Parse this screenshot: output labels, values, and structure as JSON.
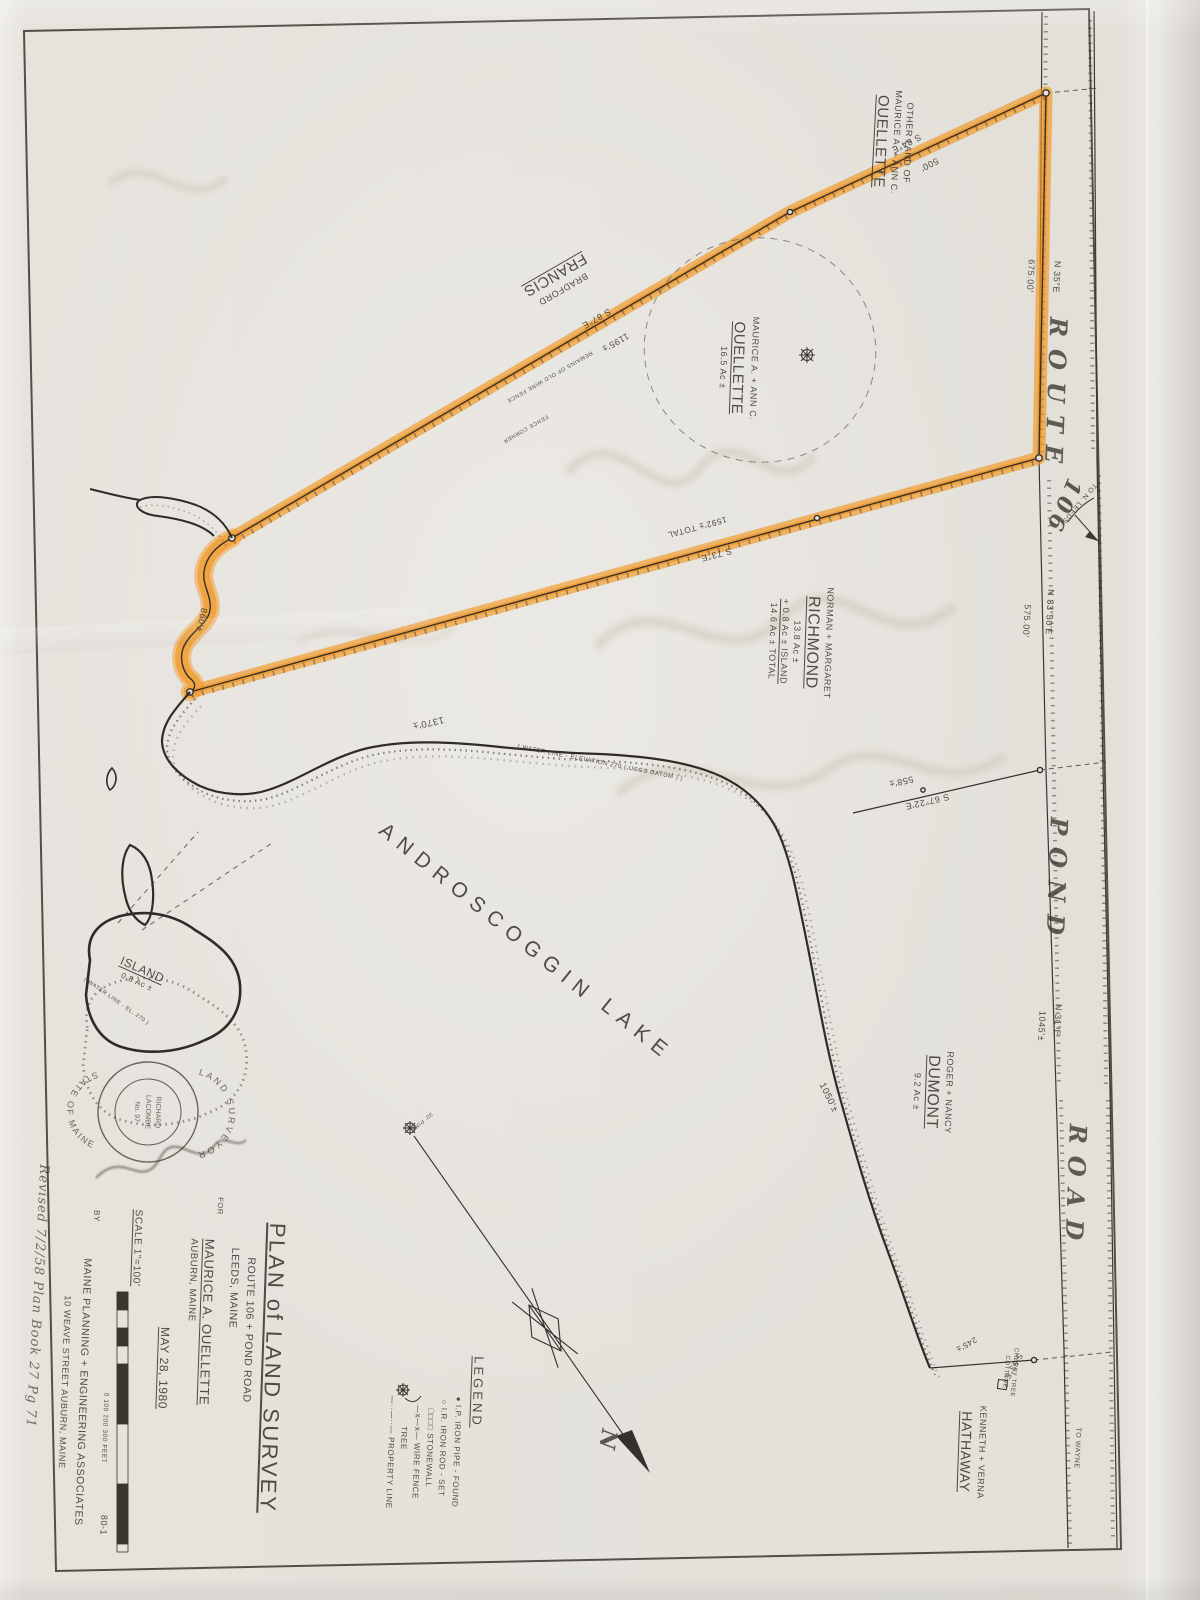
{
  "document": {
    "kind": "scanned land survey plan",
    "sheet_number": "80-1"
  },
  "colors": {
    "highlighter_orange": "#f29318",
    "ink": "#3a352f",
    "paper": "#e3e0da"
  },
  "stamp": {
    "ring_top": "LAND SURVEYOR",
    "ring_bottom": "STATE OF MAINE",
    "line1": "RICHARD",
    "line2": "LACOMBE",
    "line3": "No. 97"
  },
  "labels": [
    {
      "name": "owner-other-land-ouellette",
      "x": 892,
      "y": 142,
      "rot": 93,
      "size": 9,
      "lines": [
        {
          "t": "OTHER LAND OF"
        },
        {
          "t": "MAURICE A. + ANN C."
        },
        {
          "t": "OUELLETTE",
          "u": true,
          "s": 15
        }
      ]
    },
    {
      "name": "owner-francis",
      "x": 558,
      "y": 280,
      "rot": 150,
      "size": 9,
      "lines": [
        {
          "t": "BRADFORD"
        },
        {
          "t": "FRANCIS",
          "u": true,
          "s": 15
        }
      ]
    },
    {
      "name": "owner-ouellette-parcel",
      "x": 738,
      "y": 368,
      "rot": 92,
      "size": 9,
      "lines": [
        {
          "t": "MAURICE A. + ANN C."
        },
        {
          "t": "OUELLETTE",
          "u": true,
          "s": 15
        },
        {
          "t": "16.5 Ac ±"
        }
      ]
    },
    {
      "name": "owner-richmond",
      "x": 800,
      "y": 642,
      "rot": 92,
      "size": 9,
      "lines": [
        {
          "t": "NORMAN + MARGARET"
        },
        {
          "t": "RICHMOND",
          "u": true,
          "s": 16
        },
        {
          "t": "13.8 Ac ±"
        },
        {
          "t": "+ 0.8 Ac ± ISLAND",
          "u": true
        },
        {
          "t": "14.6 Ac ± TOTAL"
        }
      ]
    },
    {
      "name": "owner-dumont",
      "x": 932,
      "y": 1092,
      "rot": 92,
      "size": 9,
      "lines": [
        {
          "t": "ROGER + NANCY"
        },
        {
          "t": "DUMONT",
          "u": true,
          "s": 16
        },
        {
          "t": "9.2 Ac ±"
        }
      ]
    },
    {
      "name": "owner-hathaway",
      "x": 972,
      "y": 1452,
      "rot": 92,
      "size": 9,
      "lines": [
        {
          "t": "KENNETH + VERNA"
        },
        {
          "t": "HATHAWAY",
          "u": true,
          "s": 14
        }
      ]
    },
    {
      "name": "cherry-tree-cottage",
      "x": 1009,
      "y": 1372,
      "rot": 95,
      "size": 6,
      "lines": [
        {
          "t": "CHERRY TREE"
        },
        {
          "t": "COTTAGE"
        }
      ]
    },
    {
      "name": "road-route",
      "cls": "road",
      "x": 1056,
      "y": 396,
      "rot": 92,
      "size": 24,
      "text": "ROUTE"
    },
    {
      "name": "road-route-number",
      "cls": "num",
      "x": 1063,
      "y": 506,
      "rot": 114,
      "size": 22,
      "text": "106"
    },
    {
      "name": "road-pond",
      "cls": "road",
      "x": 1057,
      "y": 882,
      "rot": 92,
      "size": 24,
      "text": "POND"
    },
    {
      "name": "road-road",
      "cls": "road",
      "x": 1076,
      "y": 1188,
      "rot": 92,
      "size": 24,
      "text": "ROAD"
    },
    {
      "name": "note-to-n-leeds",
      "x": 1079,
      "y": 503,
      "rot": 130,
      "size": 7,
      "text": "TO N. LEEDS"
    },
    {
      "name": "note-to-wayne",
      "x": 1077,
      "y": 1448,
      "rot": 93,
      "size": 7,
      "text": "TO WAYNE"
    },
    {
      "name": "bearing-n35e",
      "x": 1056,
      "y": 277,
      "rot": 93,
      "size": 9,
      "text": "N 35°E"
    },
    {
      "name": "dist-675",
      "x": 1030,
      "y": 276,
      "rot": 93,
      "size": 9,
      "text": "675.00'"
    },
    {
      "name": "bearing-s84e",
      "x": 906,
      "y": 143,
      "rot": 153,
      "size": 9,
      "text": "S 84°E"
    },
    {
      "name": "dist-500",
      "x": 929,
      "y": 164,
      "rot": 153,
      "size": 9,
      "text": "500'"
    },
    {
      "name": "bearing-s87e",
      "x": 596,
      "y": 318,
      "rot": 150,
      "size": 9,
      "text": "S 87°E"
    },
    {
      "name": "dist-1195",
      "x": 615,
      "y": 342,
      "rot": 150,
      "size": 9,
      "text": "1195'±"
    },
    {
      "name": "bearing-s73e",
      "x": 716,
      "y": 554,
      "rot": 165,
      "size": 9,
      "text": "S 73°E"
    },
    {
      "name": "dist-1592",
      "x": 697,
      "y": 527,
      "rot": 165,
      "size": 8.5,
      "text": "1592'± TOTAL"
    },
    {
      "name": "bearing-n33-30e",
      "x": 1049,
      "y": 612,
      "rot": 93,
      "size": 9,
      "text": "N 33°30'E"
    },
    {
      "name": "dist-575",
      "x": 1026,
      "y": 621,
      "rot": 93,
      "size": 9,
      "text": "575.00'"
    },
    {
      "name": "bearing-s67-22e",
      "x": 927,
      "y": 801,
      "rot": 167,
      "size": 9,
      "text": "S 67°22'E"
    },
    {
      "name": "dist-558",
      "x": 901,
      "y": 781,
      "rot": 167,
      "size": 9,
      "text": "558'±"
    },
    {
      "name": "bearing-n31e",
      "x": 1057,
      "y": 1020,
      "rot": 93,
      "size": 9,
      "text": "N 31°E"
    },
    {
      "name": "dist-1045",
      "x": 1041,
      "y": 1026,
      "rot": 93,
      "size": 9,
      "text": "1045'±"
    },
    {
      "name": "bearing-s53e",
      "x": 1013,
      "y": 1366,
      "rot": 120,
      "size": 8,
      "text": "S 53°E"
    },
    {
      "name": "dist-245",
      "x": 966,
      "y": 1344,
      "rot": 150,
      "size": 8,
      "text": "245'±"
    },
    {
      "name": "dist-860",
      "x": 201,
      "y": 620,
      "rot": 103,
      "size": 9,
      "text": "860'±"
    },
    {
      "name": "dist-1370",
      "x": 428,
      "y": 722,
      "rot": 168,
      "size": 9.5,
      "text": "1370'±"
    },
    {
      "name": "dist-1050",
      "x": 828,
      "y": 1098,
      "rot": 64,
      "size": 9.5,
      "text": "1050'±"
    },
    {
      "name": "lake-name-1",
      "x": 487,
      "y": 913,
      "rot": 39,
      "size": 21,
      "ls": 8,
      "text": "ANDROSCOGGIN"
    },
    {
      "name": "lake-name-2",
      "x": 637,
      "y": 1030,
      "rot": 39,
      "size": 21,
      "ls": 8,
      "text": "LAKE"
    },
    {
      "name": "island-label",
      "x": 140,
      "y": 975,
      "rot": 24,
      "size": 8,
      "lines": [
        {
          "t": "ISLAND",
          "u": true,
          "s": 12
        },
        {
          "t": "0.8 Ac ±"
        }
      ]
    },
    {
      "name": "note-water-line",
      "x": 600,
      "y": 764,
      "rot": 11,
      "size": 6,
      "text": "( WATER LINE - ELEVATION 270 ( USGS DATUM ) )"
    },
    {
      "name": "note-island-water-line",
      "x": 116,
      "y": 1002,
      "rot": 35,
      "size": 5.5,
      "text": "( WATER LINE - EL. 270 )"
    },
    {
      "name": "note-wire-fence",
      "x": 549,
      "y": 376,
      "rot": 150,
      "size": 5.5,
      "text": "REMAINS OF OLD WIRE FENCE"
    },
    {
      "name": "note-fence-corner",
      "x": 525,
      "y": 428,
      "rot": 150,
      "size": 5.5,
      "text": "FENCE CORNER"
    },
    {
      "name": "note-pine",
      "x": 421,
      "y": 1121,
      "rot": 140,
      "size": 5.5,
      "text": "30' PINE"
    },
    {
      "name": "north-arrow-n",
      "cls": "num",
      "x": 607,
      "y": 1441,
      "rot": 100,
      "size": 22,
      "text": "N"
    },
    {
      "name": "title-plan-of-land-survey",
      "cls": "big",
      "x": 272,
      "y": 1368,
      "rot": 92,
      "size": 22,
      "lines": [
        {
          "t": "PLAN of LAND SURVEY",
          "u": true
        }
      ]
    },
    {
      "name": "title-route-pond-road",
      "x": 248,
      "y": 1330,
      "rot": 92,
      "size": 10.5,
      "text": "ROUTE 106 + POND ROAD"
    },
    {
      "name": "title-leeds-maine",
      "x": 233,
      "y": 1288,
      "rot": 92,
      "size": 10.5,
      "text": "LEEDS, MAINE"
    },
    {
      "name": "title-for",
      "x": 220,
      "y": 1206,
      "rot": 92,
      "size": 7.5,
      "text": "FOR"
    },
    {
      "name": "title-client",
      "x": 206,
      "y": 1322,
      "rot": 92,
      "size": 13,
      "lines": [
        {
          "t": "MAURICE A. OUELLETTE",
          "u": true
        }
      ]
    },
    {
      "name": "title-auburn-maine",
      "x": 192,
      "y": 1280,
      "rot": 92,
      "size": 9.5,
      "text": "AUBURN, MAINE"
    },
    {
      "name": "title-date",
      "x": 163,
      "y": 1368,
      "rot": 92,
      "size": 12,
      "lines": [
        {
          "t": "MAY 28, 1980",
          "u": true
        }
      ]
    },
    {
      "name": "title-scale",
      "x": 137,
      "y": 1248,
      "rot": 92,
      "size": 10,
      "lines": [
        {
          "t": "SCALE 1\"=100'",
          "u": true
        }
      ]
    },
    {
      "name": "scale-bar-ticks",
      "x": 104,
      "y": 1428,
      "rot": 92,
      "size": 6.5,
      "text": "0       100             200            300  FEET"
    },
    {
      "name": "title-by",
      "x": 96,
      "y": 1216,
      "rot": 92,
      "size": 8,
      "text": "BY"
    },
    {
      "name": "title-firm",
      "x": 82,
      "y": 1392,
      "rot": 92,
      "size": 10.5,
      "text": "MAINE  PLANNING + ENGINEERING  ASSOCIATES"
    },
    {
      "name": "title-firm-address",
      "x": 64,
      "y": 1382,
      "rot": 92,
      "size": 9,
      "text": "10 WEAVE STREET     AUBURN, MAINE"
    },
    {
      "name": "sheet-number",
      "x": 103,
      "y": 1525,
      "rot": 92,
      "size": 9,
      "text": "80-1"
    },
    {
      "name": "note-handwritten",
      "cls": "script",
      "x": 36,
      "y": 1296,
      "rot": 93,
      "size": 13,
      "text": "Revised  7/2/58   Plan Book 27   Pg 71"
    },
    {
      "name": "legend-title",
      "x": 477,
      "y": 1392,
      "rot": 92,
      "size": 13,
      "ls": 3,
      "lines": [
        {
          "t": "LEGEND",
          "u": true
        }
      ]
    },
    {
      "name": "legend-iron-pipe",
      "x": 456,
      "y": 1452,
      "rot": 92,
      "size": 8,
      "text": "● I.P.   IRON PIPE - FOUND"
    },
    {
      "name": "legend-iron-rod",
      "x": 442,
      "y": 1448,
      "rot": 92,
      "size": 8,
      "text": "○ I.R.   IRON ROD - SET"
    },
    {
      "name": "legend-stonewall",
      "x": 429,
      "y": 1448,
      "rot": 92,
      "size": 8,
      "text": "□□□□  STONEWALL"
    },
    {
      "name": "legend-wire-fence",
      "x": 416,
      "y": 1452,
      "rot": 92,
      "size": 8,
      "text": "—x—x—  WIRE FENCE"
    },
    {
      "name": "legend-tree",
      "x": 403,
      "y": 1438,
      "rot": 92,
      "size": 8,
      "text": "TREE"
    },
    {
      "name": "legend-property-line",
      "x": 390,
      "y": 1452,
      "rot": 92,
      "size": 8,
      "text": "—··—··—  PROPERTY LINE"
    }
  ]
}
